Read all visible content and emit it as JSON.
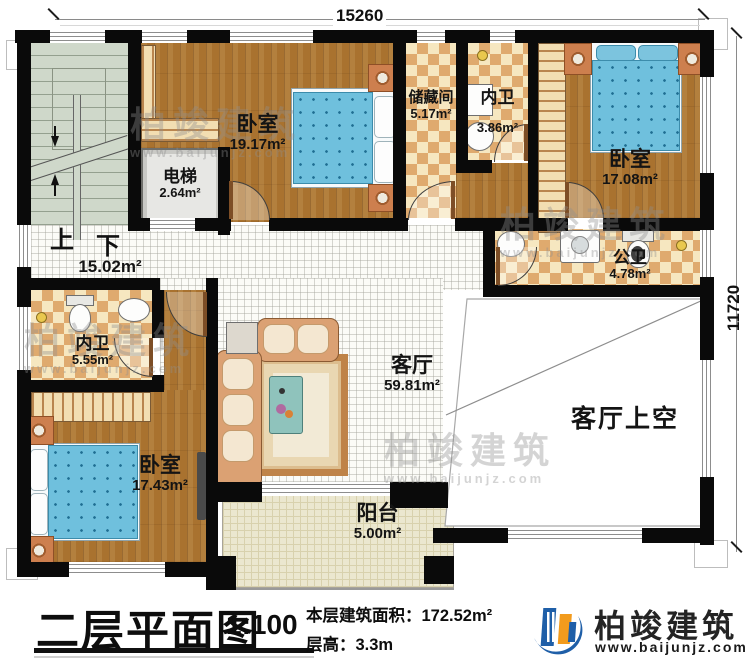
{
  "plan": {
    "title": "二层平面图",
    "scale": "1:100",
    "area_label": "本层建筑面积：",
    "area_value": "172.52m²",
    "height_label": "层高：",
    "height_value": "3.3m"
  },
  "dims": {
    "top": "15260",
    "right": "11720"
  },
  "brand": {
    "name": "柏竣建筑",
    "url": "www.baijunjz.com"
  },
  "watermark": {
    "name": "柏竣建筑",
    "url": "www.baijunjz.com"
  },
  "stairs": {
    "up": "上",
    "down": "下"
  },
  "rooms": {
    "bedroom_tl": {
      "name": "卧室",
      "area": "19.17m²"
    },
    "elevator": {
      "name": "电梯",
      "area": "2.64m²"
    },
    "storage": {
      "name": "储藏间",
      "area": "5.17m²"
    },
    "bath_top": {
      "name": "内卫",
      "area": "3.86m²"
    },
    "bedroom_tr": {
      "name": "卧室",
      "area": "17.08m²"
    },
    "bath_public": {
      "name": "公卫",
      "area": "4.78m²"
    },
    "hallway": {
      "area": "15.02m²"
    },
    "bath_left": {
      "name": "内卫",
      "area": "5.55m²"
    },
    "living": {
      "name": "客厅",
      "area": "59.81m²"
    },
    "living_void": {
      "name": "客厅上空"
    },
    "bedroom_bl": {
      "name": "卧室",
      "area": "17.43m²"
    },
    "balcony": {
      "name": "阳台",
      "area": "5.00m²"
    }
  }
}
